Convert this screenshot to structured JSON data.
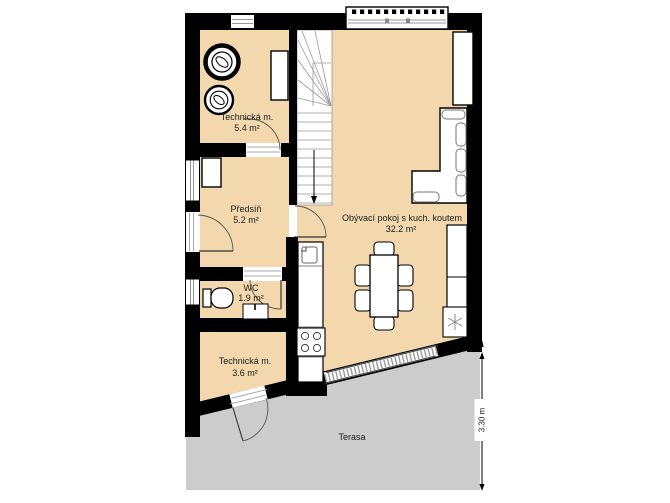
{
  "plan": {
    "rooms": [
      {
        "id": "technicka-1",
        "name": "Technická m.",
        "area": "5.4 m²"
      },
      {
        "id": "predsin",
        "name": "Předsíň",
        "area": "5.2 m²"
      },
      {
        "id": "wc",
        "name": "WC",
        "area": "1.9 m²"
      },
      {
        "id": "technicka-2",
        "name": "Technická m.",
        "area": "3.6 m²"
      },
      {
        "id": "living",
        "name": "Obývací pokoj s kuch. koutem",
        "area": "32.2 m²"
      },
      {
        "id": "terasa",
        "name": "Terasa"
      }
    ],
    "dimensions": [
      {
        "label": "3.30 m"
      }
    ],
    "colors": {
      "room_fill": "#f2d8ac",
      "terrace_fill": "#cccccc",
      "wall": "#000000",
      "background": "#ffffff"
    }
  }
}
